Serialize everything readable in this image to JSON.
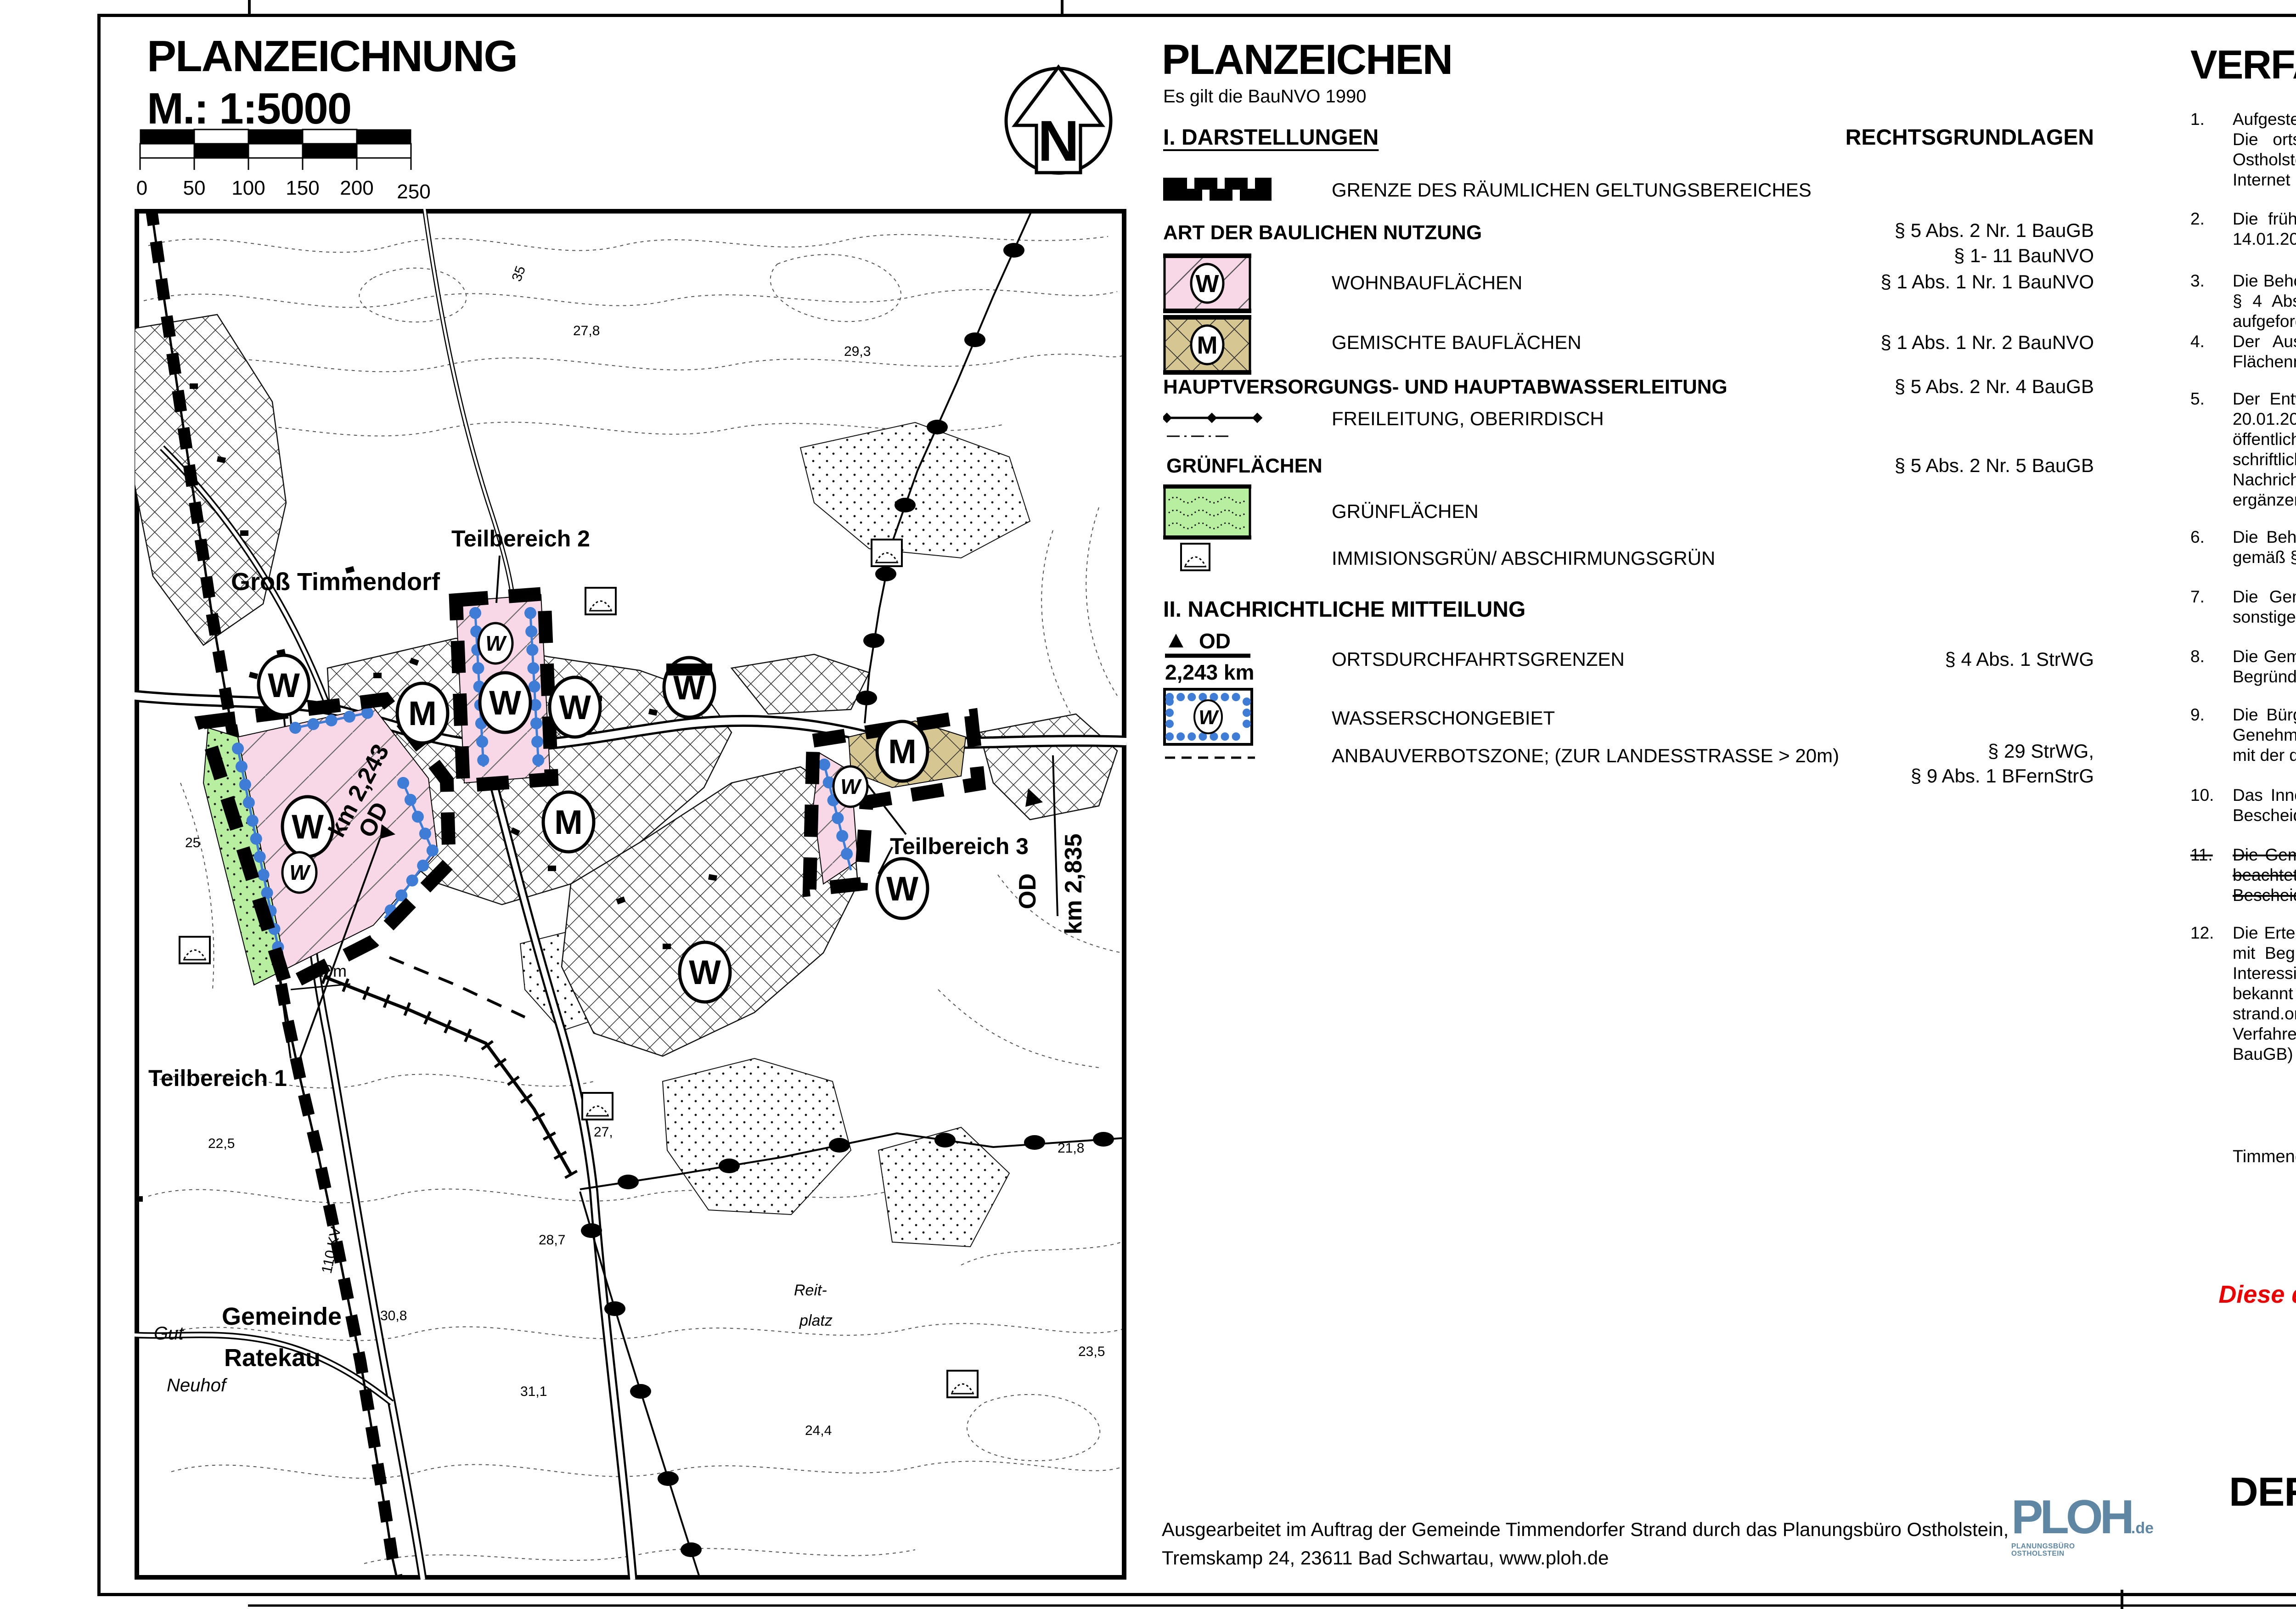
{
  "plan": {
    "title": "PLANZEICHNUNG",
    "scale": "M.: 1:5000",
    "north": "N",
    "ticks": [
      "0",
      "50",
      "100",
      "150",
      "200",
      "250"
    ]
  },
  "map": {
    "w": "W",
    "m": "M",
    "labels": {
      "gross": "Groß Timmendorf",
      "tb1": "Teilbereich 1",
      "tb2": "Teilbereich 2",
      "tb3": "Teilbereich 3",
      "gem1": "Gemeinde",
      "gem2": "Ratekau",
      "gut": "Gut",
      "neuhof": "Neuhof",
      "reit": "Reit-",
      "platz": "platz",
      "kv": "110 KV",
      "od": "OD",
      "km243": "km 2,243",
      "km835": "km 2,835",
      "m20": "20m"
    },
    "elev": {
      "e278": "27,8",
      "e293": "29,3",
      "e35": "35",
      "e225": "22,5",
      "e308": "30,8",
      "e311": "31,1",
      "e287": "28,7",
      "e27": "27,",
      "e244": "24,4",
      "e235": "23,5",
      "e218": "21,8",
      "e25": "25"
    }
  },
  "legend": {
    "title": "PLANZEICHEN",
    "note": "Es gilt die BauNVO 1990",
    "sec1": "I. DARSTELLUNGEN",
    "rights": "RECHTSGRUNDLAGEN",
    "grenze": "GRENZE DES RÄUMLICHEN GELTUNGSBEREICHES",
    "art": "ART DER BAULICHEN NUTZUNG",
    "art_ref1": "§ 5 Abs. 2 Nr. 1 BauGB",
    "art_ref2": "§ 1- 11 BauNVO",
    "wohn": "WOHNBAUFLÄCHEN",
    "wohn_ref": "§ 1 Abs. 1 Nr. 1 BauNVO",
    "gemischt": "GEMISCHTE BAUFLÄCHEN",
    "gemischt_ref": "§ 1 Abs. 1 Nr. 2 BauNVO",
    "haupt": "HAUPTVERSORGUNGS- UND HAUPTABWASSERLEITUNG",
    "haupt_ref": "§ 5 Abs. 2 Nr. 4 BauGB",
    "frei": "FREILEITUNG, OBERIRDISCH",
    "gruen_head": "GRÜNFLÄCHEN",
    "gruen_ref": "§ 5 Abs. 2 Nr. 5 BauGB",
    "gruen": "GRÜNFLÄCHEN",
    "immis": "IMMISIONSGRÜN/ ABSCHIRMUNGSGRÜN",
    "sec2": "II. NACHRICHTLICHE MITTEILUNG",
    "od": "OD",
    "od_km": "2,243 km",
    "orts": "ORTSDURCHFAHRTSGRENZEN",
    "orts_ref": "§ 4 Abs. 1 StrWG",
    "wsg": "WASSERSCHONGEBIET",
    "wsg_w": "W",
    "anbau": "ANBAUVERBOTSZONE; (ZUR LANDESSTRASSE > 20m)",
    "anbau_ref1": "§ 29 StrWG,",
    "anbau_ref2": "§ 9 Abs. 1 BFernStrG"
  },
  "footer": {
    "line1": "Ausgearbeitet im Auftrag der Gemeinde Timmendorfer Strand durch das Planungsbüro Ostholstein,",
    "line2": "Tremskamp 24, 23611 Bad Schwartau, www.ploh.de",
    "logo": "PLOH",
    "logo_de": ".de",
    "logo_sub": "PLANUNGSBÜRO OSTHOLSTEIN"
  },
  "verf": {
    "title": "VERFAHRENSVERMERKE",
    "items": [
      {
        "n": "1.",
        "t": "Aufgestellt aufgrund des Aufstellungsbeschlusses des Ausschusses für Planung und Bauwesen vom 10.09.2012. Die ortsübliche Bekanntmachung des Aufstellungsbeschlusses erfolgte in den „Lübecker Nachrichten, Ostholsteiner Nachrichten Süd“ am 04.01.2013. Die Bekanntmachung wurde ergänzend am 04.01.2013 im Internet unter www.timmendorfer-strand.org veröffentlicht."
      },
      {
        "n": "2.",
        "t": "Die frühzeitige Beteiligung der Öffentlichkeit nach § 3 Abs. 1 Satz 1 BauGB wurde durch Aushang vom 14.01.2013 bis zum 28.01.2013 durchgeführt."
      },
      {
        "n": "3.",
        "t": "Die Behörden und sonstigen Träger öffentlicher Belange, die von der Planung berührt sein können, wurden gem. § 4 Abs. 1 i.V.m. § 3 Abs. 1 BauGB am 13.09.2012 unterrichtet und zur Abgabe einer Stellungnahme aufgefordert."
      },
      {
        "n": "4.",
        "t": "Der Ausschuss für Planung und Bauwesen hat am 24.10.2013 den Entwurf der 59. Änderung des Flächennutzungsplanes und die Begründung beschlossen und zur Auslegung bestimmt."
      },
      {
        "n": "5.",
        "t": "Der Entwurf der 59. Änderung des Flächennutzungsplanes sowie die Begründung haben in der Zeit vom 20.01.2014 bis zum 21.02.2014 während der Dienststunden nach § 3 Abs. 2 BauGB öffentlich ausgelegen. Die öffentliche Auslegung wurde mit dem Hinweis, dass Stellungnahmen während der Auslegungsfrist von jedermann schriftlich oder durch Niederschrift geltend gemacht werden können, am 10.01.2014 in den „Lübecker Nachrichten, Ostholsteiner Nachrichten Süd“ ortsüblich  bekannt gemacht. Die Bekanntmachung wurde ergänzend am 10.01.2014 im Internet unter www.timmendorfer-strand.org veröffentlicht."
      },
      {
        "n": "6.",
        "t": "Die Behörden und sonstigen Träger öffentlicher Belange, die von der Planung berührt sein können, wurden gemäß § 4 Abs. 2 BauGB am 08.01.2014 zur Abgabe einer Stellungnahme aufgefordert."
      },
      {
        "n": "7.",
        "t": "Die Gemeindevertretung hat die abgegebenen Stellungnahmen der Öffentlichkeit und der Behörden und sonstigen Träger öffentlicher Belange am 26.06.2014 geprüft. Das Ergebnis wurde mitgeteilt."
      },
      {
        "n": "8.",
        "t": "Die Gemeindevertretung hat die 59. Änderung des Flächennutzungsplanes am 26.06.2014 beschlossen und die Begründung durch Beschluss gebilligt."
      },
      {
        "n": "9.",
        "t": "Die Bürgermeisterin hat die Übereinstimmung der dem Innenministerium des Landes Schleswig-Holstein zur Genehmigung zugeleiteten Fassung der 59. Änderung des Flächennutzungsplanes einschließlich Planzeichnung mit der  durch die planende Gemeinde beschlossenen Fassung durch seine Unterschrift bestätigt."
      },
      {
        "n": "10.",
        "t": "Das Innenministerium des Landes Schleswig- Holstein hat die 59. Änderung des Flächennutzungsplanes mit Bescheid vom 03.12.2014 Az.:IV263-512.III-55.42(59.Ä) -mit Nebenbestimmungen und Hinweisen- genehmigt."
      },
      {
        "n": "11.",
        "t": "Die Gemeindevertretung hat die Nebenbestimmungen durch Beschluss vom ............. erfüllt, die Hinweise sind beachtet. Das Innenministerium des Landes Schleswig- Holstein hat die Erfüllung der Nebenbestimmungen mit Bescheid vom ............. Az.: ............................................................... bestätigt."
      },
      {
        "n": "12.",
        "t": "Die Erteilung der Genehmigung der 59. Änderung des Flächennutzungplanes sowie die Stelle, bei der der Plan mit Begründung und der zusammenfassenden Erklärung auf Dauer während der Sprechstunden von allen Interessierten eingesehen werden kann und die über den Inhalt Auskunft erteilt, wurde am 19.02.2015 ortsüblich bekannt gegeben. Die Bekanntmachung wurde ergänzend am 19.02.2015 im Internet unter www.timmendorfer-strand.org veröffentlicht. In der Bekanntmachung wurde auf die Möglichkeit einer Geltendmachung von Verfahrens- und Formverstößenund von Mängeln der Abwägung sowie auf die Rechtsfolgen (§ 215 Abs. 2 BauGB) hingewiesen. Die 59. Änderung des Flächennutzungsplanes wurde mithin am 20.02.2015 wirksam."
      }
    ],
    "sig": {
      "place": "Timmendorfer Strand, den 20.02.2015",
      "siegel": "Siegel",
      "kara": "(Kara)",
      "bauer": "(Bauer)",
      "stell": "-1. stellvertretende",
      "bgm_struck": "-Bürgermeisterin-",
      "bgm": "Bürgermeisterin-"
    },
    "note": "Diese digitale Fassung entspricht der rechtsverbindlichen Ausfertigung",
    "block": {
      "l1": "59. ÄNDERUNG  DES",
      "l2": "FLÄCHENNUTZUNGSPLANES",
      "l3": "DER GEMEINDE TIMMENDORFER STRAND",
      "sub": "für 3 Teilbereiche in Groß Timmendorf",
      "stand": "Stand: 26. Juni 2014"
    }
  }
}
